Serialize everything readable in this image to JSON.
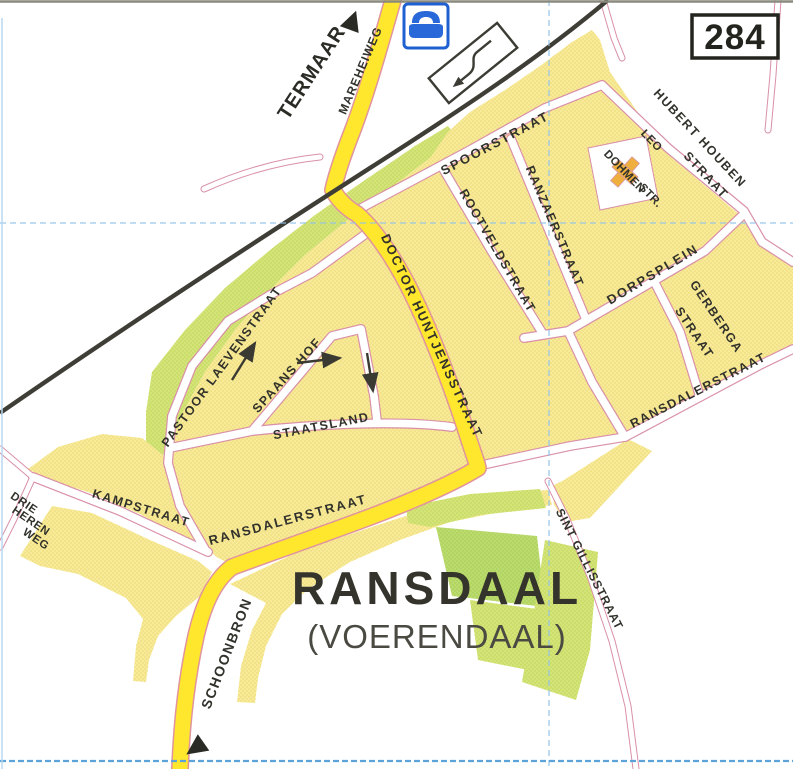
{
  "map": {
    "sheet_number": "284",
    "title": "RANSDAAL",
    "subtitle": "(VOERENDAAL)",
    "colors": {
      "built_up_area": "#f8eb98",
      "main_road": "#ffe72e",
      "park_green": "#d4e478",
      "dark_green": "#bcdb6e",
      "railway": "#3f3e36",
      "street_casing_pink": "#d990a8",
      "grid_blue": "#8fc2e8",
      "label_dark": "#32322c",
      "icon_blue": "#2968d8",
      "church_orange": "#efaf3e"
    }
  },
  "offmap": {
    "north_destination": "TERMAAR",
    "south_destination": "SCHOONBRON"
  },
  "streets": {
    "mareheiweg": "MAREHEIWEG",
    "spoorstraat": "SPOORSTRAAT",
    "ranzaerstraat": "RANZAERSTRAAT",
    "rootveldstraat": "ROOTVELDSTRAAT",
    "hubert_houben_line1": "HUBERT HOUBEN",
    "hubert_houben_line2": "STRAAT",
    "leo_dohmen_line1": "LEO",
    "leo_dohmen_line2": "DOHMEN",
    "leo_dohmen_line3": "STR.",
    "dorpsplein": "DORPSPLEIN",
    "gerberga_line1": "GERBERGA",
    "gerberga_line2": "STRAAT",
    "doctor_huntjensstraat": "DOCTOR  HUNTJENSSTRAAT",
    "ransdalerstraat": "RANSDALERSTRAAT",
    "sint_gillisstraat": "SINT GILLISSTRAAT",
    "pastoor_laevenstraat": "PASTOOR LAEVENSTRAAT",
    "spaans_hof": "SPAANS HOF",
    "staatsland": "STAATSLAND",
    "kampstraat": "KAMPSTRAAT",
    "drie_heren_weg_line1": "DRIE",
    "drie_heren_weg_line2": "HEREN",
    "drie_heren_weg_line3": "WEG"
  },
  "icons": {
    "railway_crossing": "railway-crossing-symbol",
    "car_symbol": "car-symbol",
    "church": "church-symbol",
    "one_way_arrows": "one-way-arrows",
    "direction_triangles": "off-map-direction-triangles"
  }
}
